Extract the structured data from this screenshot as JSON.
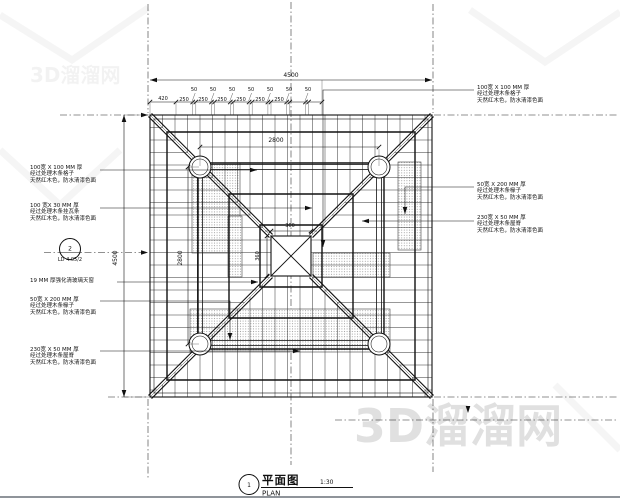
{
  "watermark": {
    "site": "3D溜溜网"
  },
  "detail_ref": {
    "number": "2",
    "sheet": "LD 4.05/2"
  },
  "title_block": {
    "number": "1",
    "name_cn": "平面图",
    "name_en": "PLAN",
    "scale": "1:30"
  },
  "dims": {
    "overall": "4500",
    "bay": "2800",
    "center": "360",
    "offset": "420",
    "slat": "250",
    "gap": "50"
  },
  "callouts": {
    "left": [
      {
        "size": "100宽 X 100 MM 厚",
        "part": "经过处理木条格子",
        "finish": "天然红木色，防水清漆色面"
      },
      {
        "size": "100 宽X 30 MM 厚",
        "part": "经过处理木条挂瓦条",
        "finish": "天然红木色，防水清漆色面"
      },
      {
        "size": "19 MM 厚强化清玻璃天窗",
        "part": "",
        "finish": ""
      },
      {
        "size": "50宽 X 200 MM 厚",
        "part": "经过处理木条椽子",
        "finish": "天然红木色，防水清漆色面"
      },
      {
        "size": "230宽 X 50 MM 厚",
        "part": "经过处理木条屋脊",
        "finish": "天然红木色，防水清漆色面"
      }
    ],
    "right": [
      {
        "size": "100宽 X 100 MM 厚",
        "part": "经过处理木条格子",
        "finish": "天然红木色，防水清漆色面"
      },
      {
        "size": "50宽 X 200 MM 厚",
        "part": "经过处理木条椽子",
        "finish": "天然红木色，防水清漆色面"
      },
      {
        "size": "230宽 X 50 MM 厚",
        "part": "经过处理木条屋脊",
        "finish": "天然红木色，防水清漆色面"
      }
    ]
  }
}
